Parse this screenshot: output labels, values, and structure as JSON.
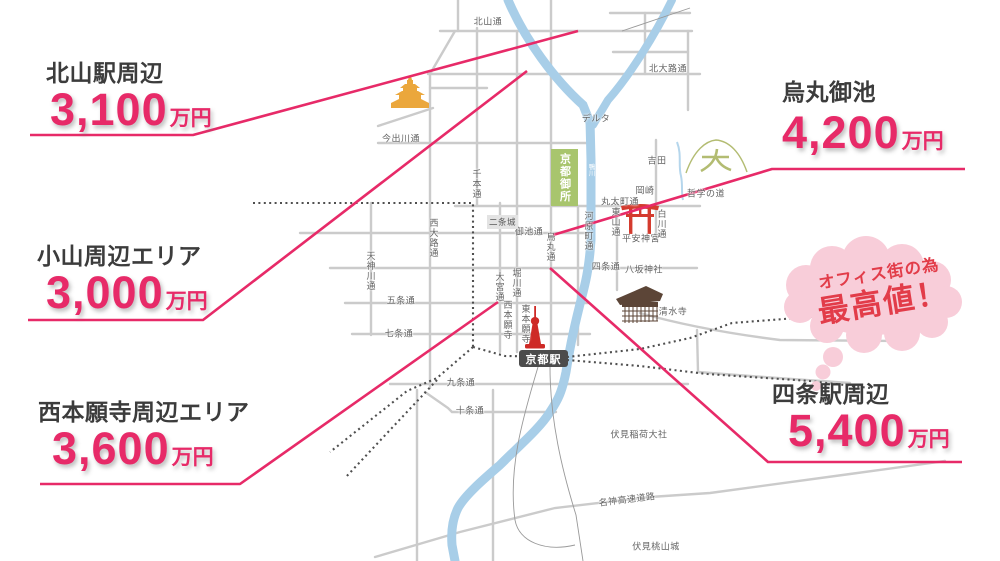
{
  "callouts": [
    {
      "area": "北山駅周辺",
      "price": "3,100",
      "unit": "万円"
    },
    {
      "area": "小山周辺エリア",
      "price": "3,000",
      "unit": "万円"
    },
    {
      "area": "西本願寺周辺エリア",
      "price": "3,600",
      "unit": "万円"
    },
    {
      "area": "烏丸御池",
      "price": "4,200",
      "unit": "万円"
    },
    {
      "area": "四条駅周辺",
      "price": "5,400",
      "unit": "万円"
    }
  ],
  "bubble": {
    "line1": "オフィス街の為",
    "line2": "最高値！"
  },
  "map": {
    "boxes": {
      "gosho": "京都御所",
      "nijo_castle": "二条城",
      "kyoto_station": "京都駅"
    },
    "streets": [
      "北山通",
      "北大路通",
      "今出川通",
      "デルタ",
      "吉田",
      "岡崎",
      "哲学の道",
      "丸太町通",
      "御池通",
      "平安神宮",
      "四条通",
      "八坂神社",
      "五条通",
      "清水寺",
      "七条通",
      "九条通",
      "十条通",
      "伏見稲荷大社",
      "名神高速道路",
      "伏見桃山城",
      "千本通",
      "西大路通",
      "天神川通",
      "大宮通",
      "堀川通",
      "烏丸通",
      "河原町通",
      "東山通",
      "白川通",
      "西本願寺",
      "東本願寺",
      "鴨川"
    ]
  },
  "colors": {
    "price_pink": "#e72a68",
    "bubble_pink": "#f8cdd9",
    "bubble_text_red": "#e23c49",
    "river_blue": "#a8cee8",
    "street_gray": "#cbcbcb",
    "gosho_green": "#a8c56d",
    "station_dark": "#4c4c4c",
    "kinkakuji_gold": "#eba73c",
    "torii_red": "#d43b2e",
    "temple_brown": "#5c4537",
    "tower_red": "#ce2a26",
    "daimonji_olive": "#b3bc72"
  }
}
